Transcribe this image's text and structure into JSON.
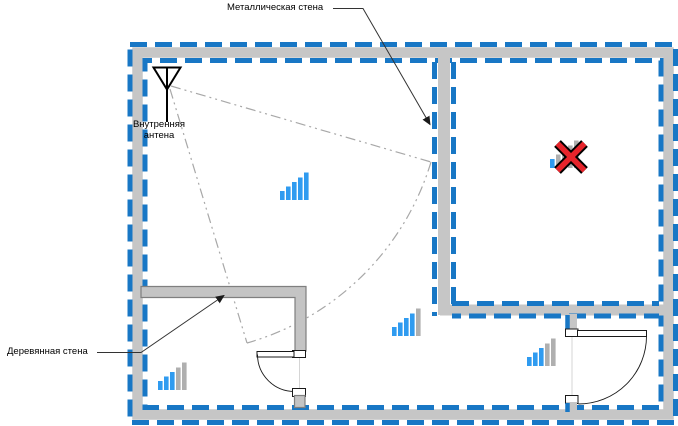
{
  "diagram": {
    "labels": {
      "metal_wall": "Металлическая стена",
      "inner_antenna": "Внутренняя антена",
      "wooden_wall": "Деревянная стена"
    },
    "colors": {
      "wall_blue": "#1877C5",
      "wall_gray": "#C6C6C6",
      "wood_fill": "#C4C4C4",
      "wood_edge": "#7F7F7F",
      "signal_blue": "#2F9BF0",
      "signal_gray": "#AFAFAF",
      "blocked_red": "#E6242B",
      "coverage": "#A8A8A8",
      "leader": "#333333"
    },
    "signals": [
      {
        "name": "signal-main-room",
        "x": 280,
        "bottom": 200,
        "bars_total": 5,
        "bars_active": 5,
        "crossed": false
      },
      {
        "name": "signal-behind-metal-wall",
        "x": 550,
        "bottom": 168,
        "bars_total": 5,
        "bars_active": 1,
        "crossed": true
      },
      {
        "name": "signal-lower-middle",
        "x": 392,
        "bottom": 336,
        "bars_total": 5,
        "bars_active": 4,
        "crossed": false
      },
      {
        "name": "signal-lower-right",
        "x": 527,
        "bottom": 366,
        "bars_total": 5,
        "bars_active": 3,
        "crossed": false
      },
      {
        "name": "signal-wooden-room",
        "x": 158,
        "bottom": 390,
        "bars_total": 5,
        "bars_active": 3,
        "crossed": false
      }
    ]
  }
}
